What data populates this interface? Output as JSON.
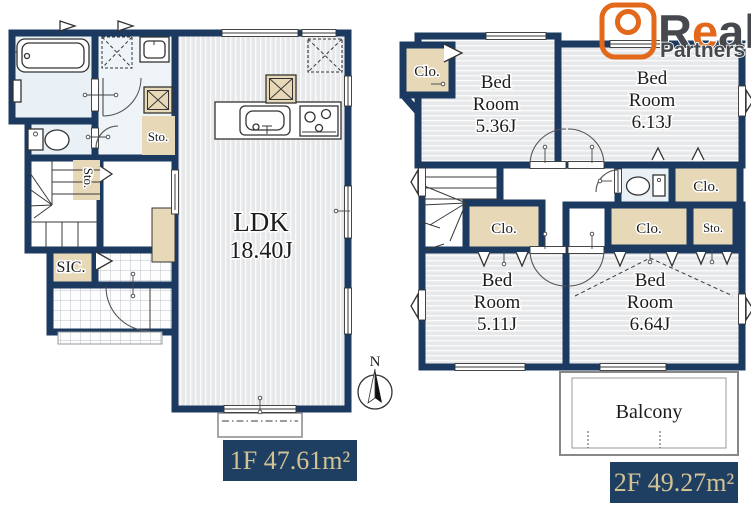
{
  "brand": {
    "part1": "R",
    "part2": "e",
    "part3": "al",
    "subtitle": "Partners"
  },
  "compass": {
    "north": "N"
  },
  "floor1": {
    "area_label": "1F 47.61m²",
    "ldk_name": "LDK",
    "ldk_size": "18.40J",
    "storage_washroom": "Sto.",
    "storage_understair": "Sto.",
    "shoe_closet": "SIC."
  },
  "floor2": {
    "area_label": "2F 49.27m²",
    "bedrooms": [
      {
        "line1": "Bed",
        "line2": "Room",
        "size": "5.36J"
      },
      {
        "line1": "Bed",
        "line2": "Room",
        "size": "6.13J"
      },
      {
        "line1": "Bed",
        "line2": "Room",
        "size": "5.11J"
      },
      {
        "line1": "Bed",
        "line2": "Room",
        "size": "6.64J"
      }
    ],
    "closet_nw": "Clo.",
    "closet_under_stairs": "Clo.",
    "closet_east": "Clo.",
    "closet_south": "Clo.",
    "storage_south": "Sto.",
    "balcony": "Balcony"
  },
  "colors": {
    "wall": "#1c3a5f",
    "closet_fill": "#e7d8b7",
    "floor_stripe": "#e7e8ea",
    "water_room": "#e9f1f6",
    "label_box": "#1e3e62",
    "label_text": "#d3c393",
    "logo_orange": "#e2691b",
    "logo_gray": "#45494e"
  }
}
